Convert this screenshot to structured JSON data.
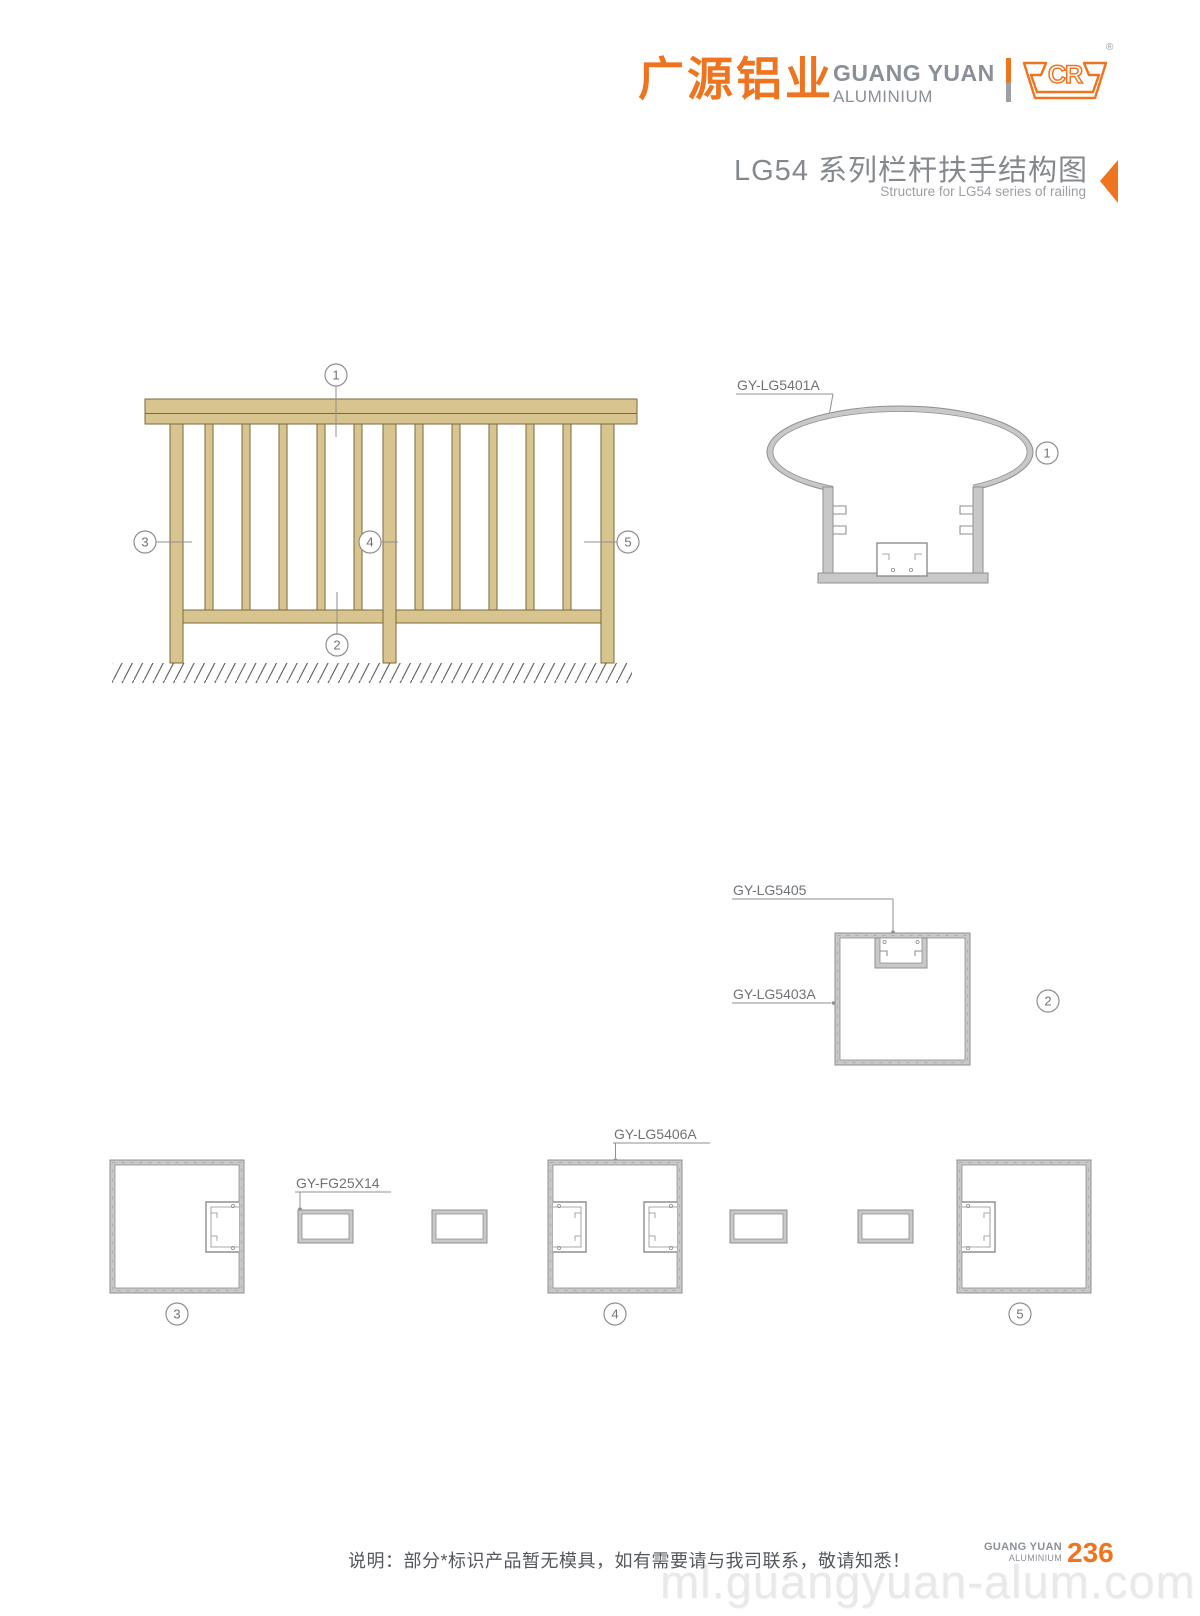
{
  "header": {
    "brand_cn": "广源铝业",
    "brand_en_line1": "GUANG YUAN",
    "brand_en_line2": "ALUMINIUM",
    "logo_text": "CR",
    "reg_mark": "®",
    "title": "LG54 系列栏杆扶手结构图",
    "subtitle": "Structure for LG54 series of railing"
  },
  "elevation": {
    "callout_1": "1",
    "callout_2": "2",
    "callout_3": "3",
    "callout_4": "4",
    "callout_5": "5"
  },
  "sections": {
    "label_handrail": "GY-LG5401A",
    "label_insert": "GY-LG5405",
    "label_bottom_rail": "GY-LG5403A",
    "label_post": "GY-LG5406A",
    "label_flat_bar": "GY-FG25X14",
    "callout_1": "1",
    "callout_2": "2",
    "callout_3": "3",
    "callout_4": "4",
    "callout_5": "5"
  },
  "footer": {
    "note": "说明：部分*标识产品暂无模具，如有需要请与我司联系，敬请知悉！",
    "brand_line1": "GUANG YUAN",
    "brand_line2": "ALUMINIUM",
    "page_number": "236",
    "watermark": "ml.guangyuan-alum.com"
  },
  "colors": {
    "accent": "#ee7420",
    "brand_gray": "#8a9097",
    "wood_fill": "#d8c48e",
    "wood_stroke": "#7a6a3c",
    "drawing_line": "#8f8f8f",
    "profile_wall_fill": "#c8c8c8"
  }
}
